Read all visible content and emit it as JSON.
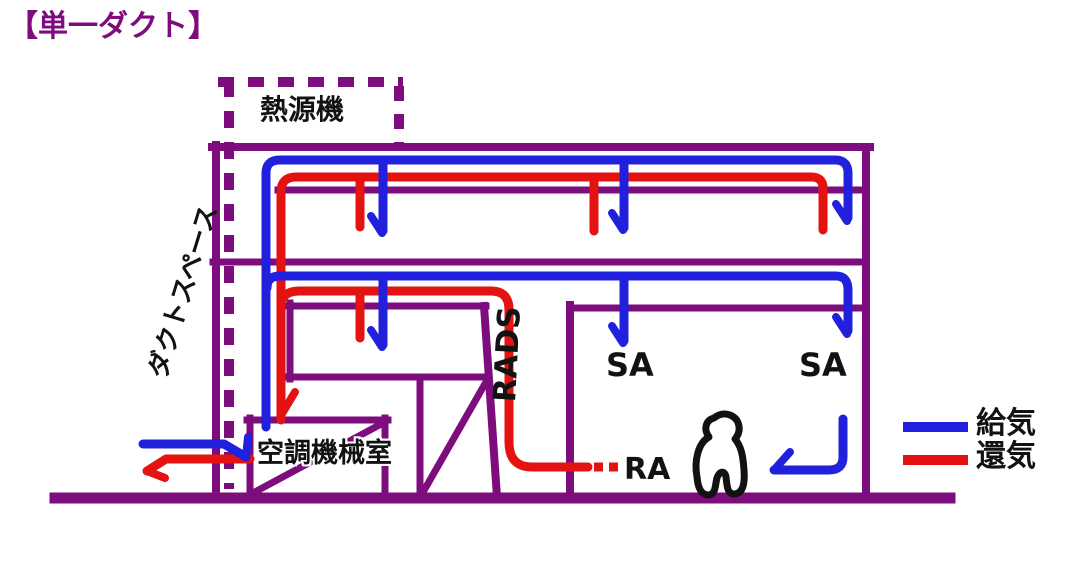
{
  "title": "【単一ダクト】",
  "colors": {
    "structure_purple": "#7d0c7d",
    "supply_blue": "#2121dd",
    "return_red": "#e51212",
    "ink_black": "#121212"
  },
  "labels": {
    "heat_source": "熱源機",
    "duct_space": "ダクトスペース",
    "machine_room": "空調機械室",
    "shaft": "RADS",
    "supply_outlet_1": "SA",
    "supply_outlet_2": "SA",
    "return_grille": "RA"
  },
  "legend": {
    "supply": {
      "label": "給気",
      "color": "#2121dd"
    },
    "return": {
      "label": "還気",
      "color": "#e51212"
    }
  }
}
